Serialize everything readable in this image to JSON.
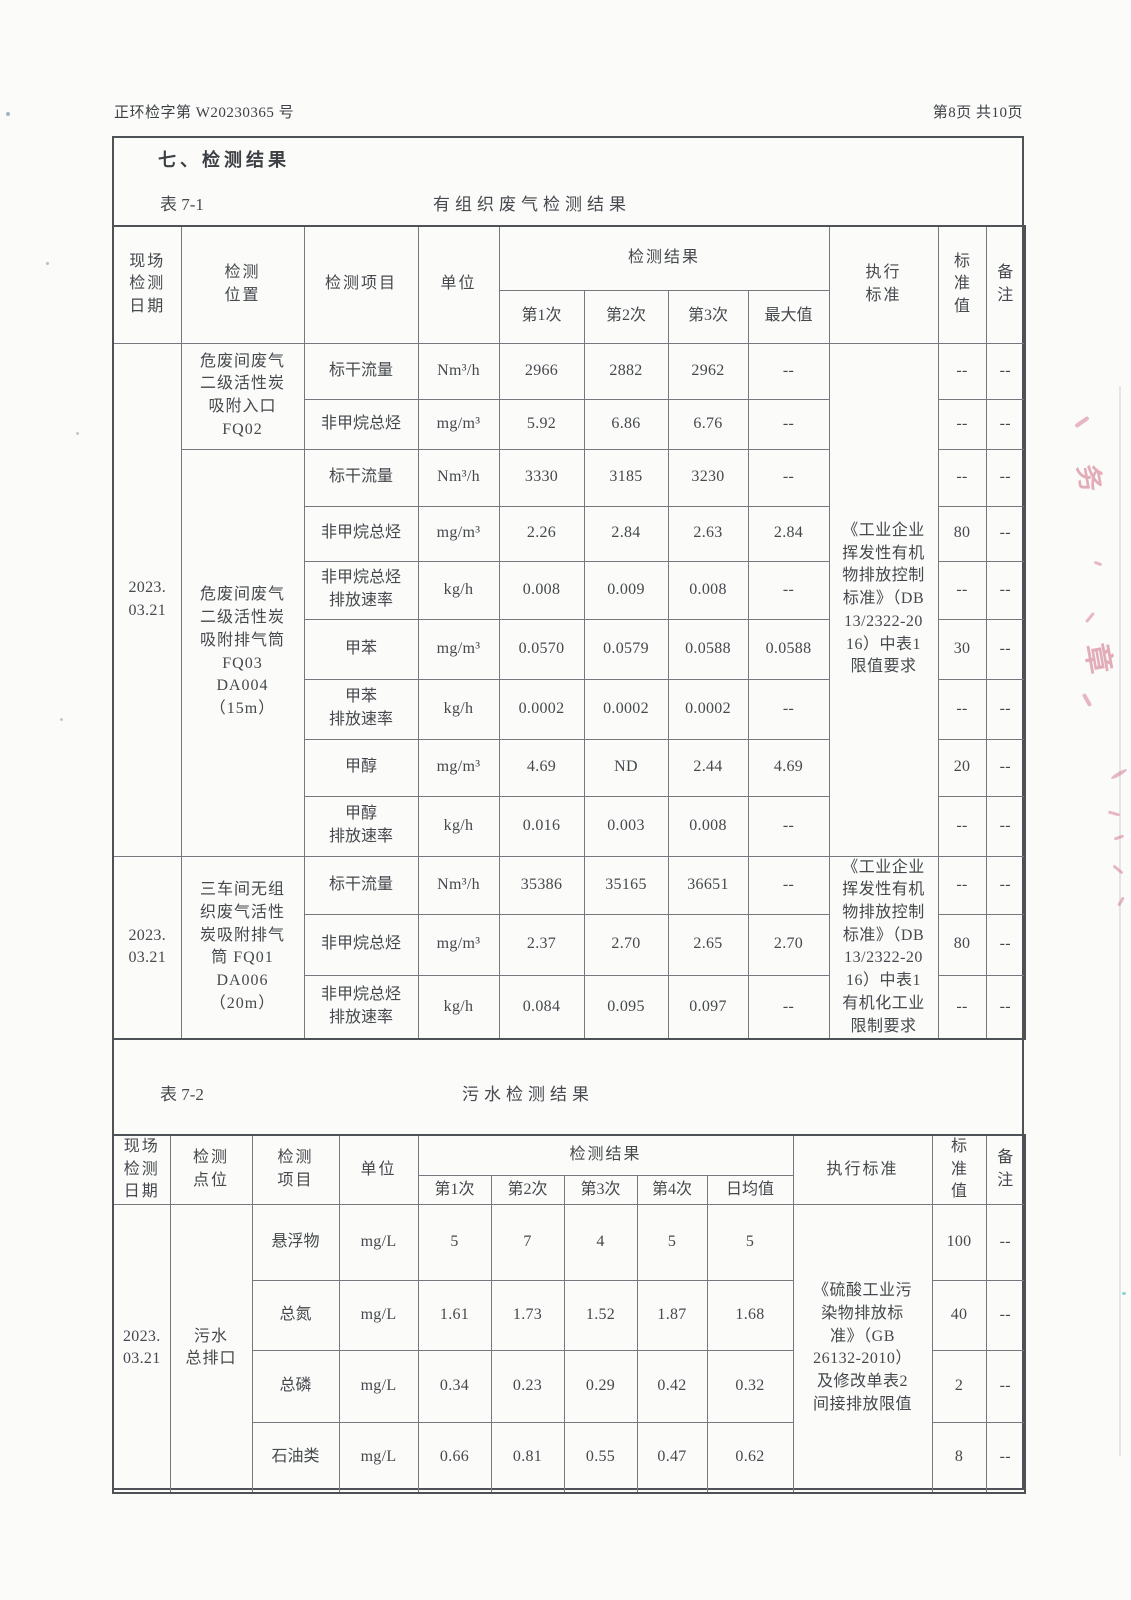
{
  "page": {
    "doc_number": "正环检字第 W20230365 号",
    "page_info": "第8页 共10页",
    "section_title": "七、检测结果"
  },
  "stamp": {
    "fragments": [
      {
        "text": "务"
      },
      {
        "text": "章"
      }
    ]
  },
  "table1": {
    "caption_label": "表 7-1",
    "caption_title": "有组织废气检测结果",
    "head": {
      "date": "现场\n检测\n日期",
      "location": "检测\n位置",
      "item": "检测项目",
      "unit": "单位",
      "result": "检测结果",
      "r1": "第1次",
      "r2": "第2次",
      "r3": "第3次",
      "max": "最大值",
      "standard": "执行\n标准",
      "limit": "标\n准\n值",
      "note": "备\n注"
    },
    "groups": [
      {
        "date": "2023.\n03.21",
        "standard": "《工业企业\n挥发性有机\n物排放控制\n标准》（DB\n13/2322-20\n16）中表1\n限值要求",
        "sections": [
          {
            "location": "危废间废气\n二级活性炭\n吸附入口\nFQ02",
            "rows": [
              {
                "item": "标干流量",
                "unit": "Nm³/h",
                "v1": "2966",
                "v2": "2882",
                "v3": "2962",
                "max": "--",
                "limit": "--",
                "note": "--"
              },
              {
                "item": "非甲烷总烃",
                "unit": "mg/m³",
                "v1": "5.92",
                "v2": "6.86",
                "v3": "6.76",
                "max": "--",
                "limit": "--",
                "note": "--"
              }
            ]
          },
          {
            "location": "危废间废气\n二级活性炭\n吸附排气筒\nFQ03\nDA004\n（15m）",
            "rows": [
              {
                "item": "标干流量",
                "unit": "Nm³/h",
                "v1": "3330",
                "v2": "3185",
                "v3": "3230",
                "max": "--",
                "limit": "--",
                "note": "--"
              },
              {
                "item": "非甲烷总烃",
                "unit": "mg/m³",
                "v1": "2.26",
                "v2": "2.84",
                "v3": "2.63",
                "max": "2.84",
                "limit": "80",
                "note": "--"
              },
              {
                "item": "非甲烷总烃\n排放速率",
                "unit": "kg/h",
                "v1": "0.008",
                "v2": "0.009",
                "v3": "0.008",
                "max": "--",
                "limit": "--",
                "note": "--"
              },
              {
                "item": "甲苯",
                "unit": "mg/m³",
                "v1": "0.0570",
                "v2": "0.0579",
                "v3": "0.0588",
                "max": "0.0588",
                "limit": "30",
                "note": "--"
              },
              {
                "item": "甲苯\n排放速率",
                "unit": "kg/h",
                "v1": "0.0002",
                "v2": "0.0002",
                "v3": "0.0002",
                "max": "--",
                "limit": "--",
                "note": "--"
              },
              {
                "item": "甲醇",
                "unit": "mg/m³",
                "v1": "4.69",
                "v2": "ND",
                "v3": "2.44",
                "max": "4.69",
                "limit": "20",
                "note": "--"
              },
              {
                "item": "甲醇\n排放速率",
                "unit": "kg/h",
                "v1": "0.016",
                "v2": "0.003",
                "v3": "0.008",
                "max": "--",
                "limit": "--",
                "note": "--"
              }
            ]
          }
        ]
      },
      {
        "date": "2023.\n03.21",
        "standard": "《工业企业\n挥发性有机\n物排放控制\n标准》（DB\n13/2322-20\n16）中表1\n有机化工业\n限制要求",
        "sections": [
          {
            "location": "三车间无组\n织废气活性\n炭吸附排气\n筒 FQ01\nDA006\n（20m）",
            "rows": [
              {
                "item": "标干流量",
                "unit": "Nm³/h",
                "v1": "35386",
                "v2": "35165",
                "v3": "36651",
                "max": "--",
                "limit": "--",
                "note": "--"
              },
              {
                "item": "非甲烷总烃",
                "unit": "mg/m³",
                "v1": "2.37",
                "v2": "2.70",
                "v3": "2.65",
                "max": "2.70",
                "limit": "80",
                "note": "--"
              },
              {
                "item": "非甲烷总烃\n排放速率",
                "unit": "kg/h",
                "v1": "0.084",
                "v2": "0.095",
                "v3": "0.097",
                "max": "--",
                "limit": "--",
                "note": "--"
              }
            ]
          }
        ]
      }
    ]
  },
  "table2": {
    "caption_label": "表 7-2",
    "caption_title": "污水检测结果",
    "head": {
      "date": "现场\n检测\n日期",
      "location": "检测\n点位",
      "item": "检测\n项目",
      "unit": "单位",
      "result": "检测结果",
      "r1": "第1次",
      "r2": "第2次",
      "r3": "第3次",
      "r4": "第4次",
      "avg": "日均值",
      "standard": "执行标准",
      "limit": "标\n准\n值",
      "note": "备\n注"
    },
    "group": {
      "date": "2023.\n03.21",
      "location": "污水\n总排口",
      "standard": "《硫酸工业污\n染物排放标\n准》（GB\n26132-2010）\n及修改单表2\n间接排放限值",
      "rows": [
        {
          "item": "悬浮物",
          "unit": "mg/L",
          "v1": "5",
          "v2": "7",
          "v3": "4",
          "v4": "5",
          "avg": "5",
          "limit": "100",
          "note": "--"
        },
        {
          "item": "总氮",
          "unit": "mg/L",
          "v1": "1.61",
          "v2": "1.73",
          "v3": "1.52",
          "v4": "1.87",
          "avg": "1.68",
          "limit": "40",
          "note": "--"
        },
        {
          "item": "总磷",
          "unit": "mg/L",
          "v1": "0.34",
          "v2": "0.23",
          "v3": "0.29",
          "v4": "0.42",
          "avg": "0.32",
          "limit": "2",
          "note": "--"
        },
        {
          "item": "石油类",
          "unit": "mg/L",
          "v1": "0.66",
          "v2": "0.81",
          "v3": "0.55",
          "v4": "0.47",
          "avg": "0.62",
          "limit": "8",
          "note": "--"
        }
      ]
    }
  }
}
